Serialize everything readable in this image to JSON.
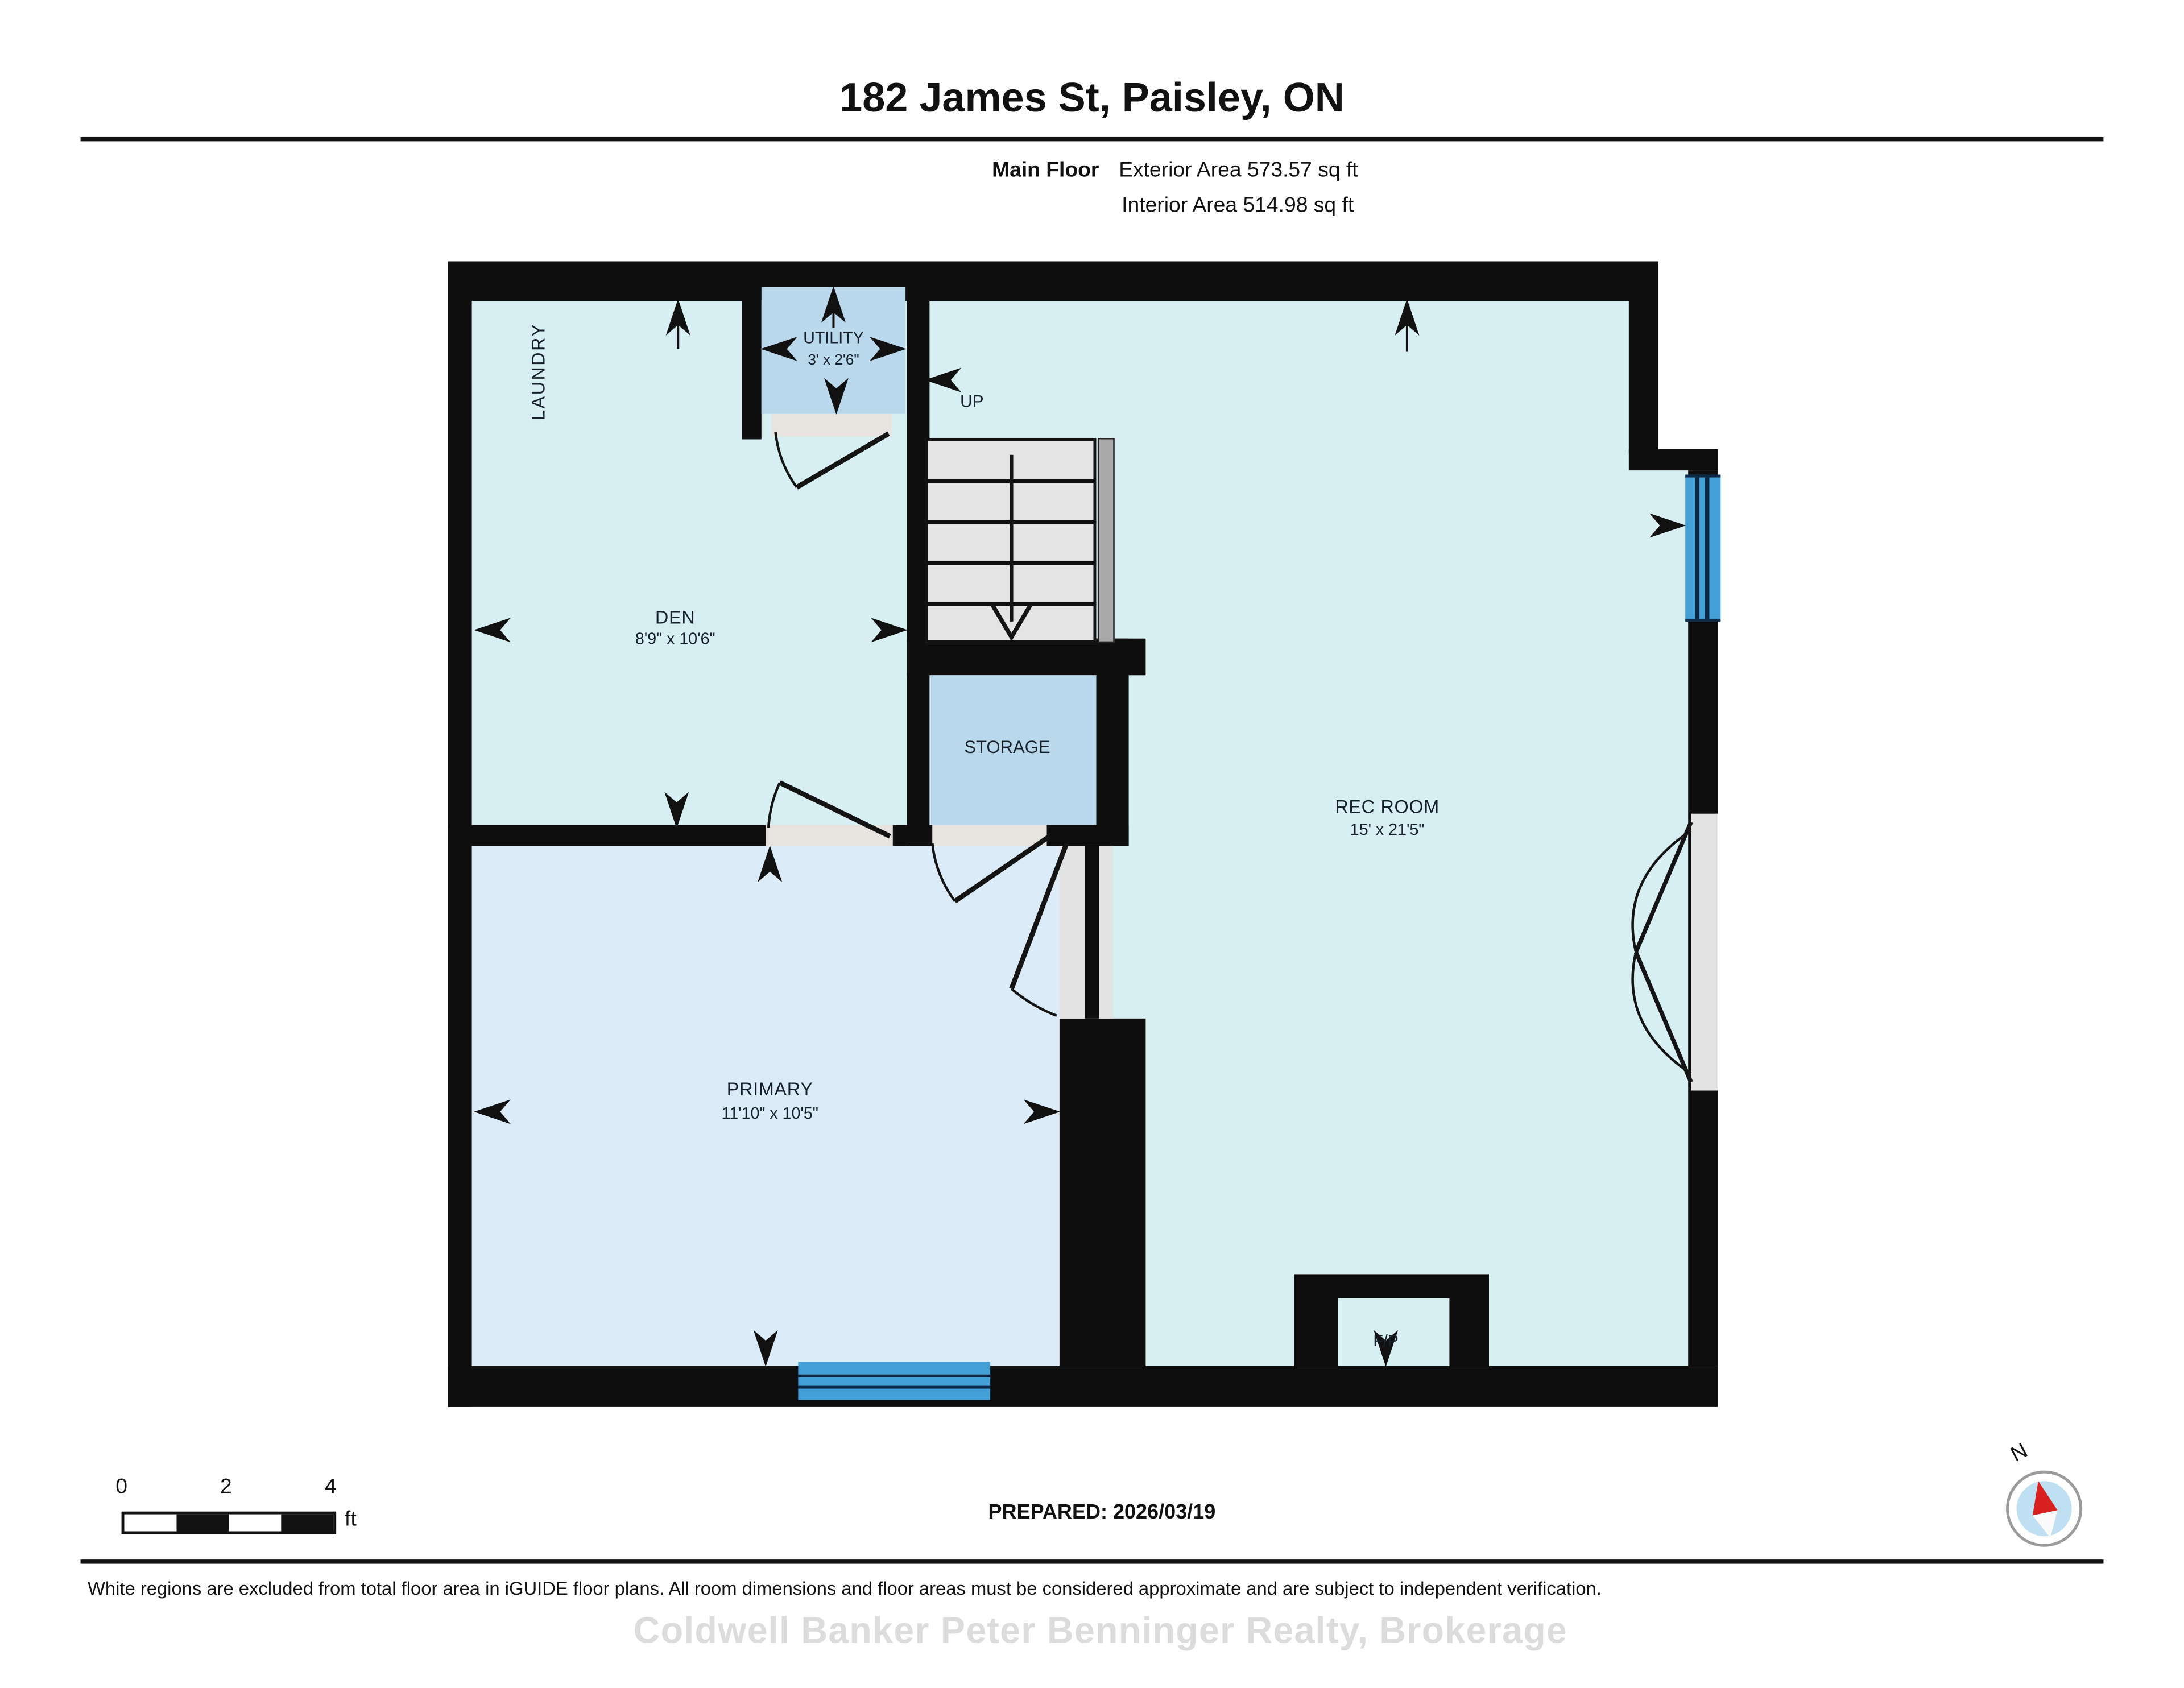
{
  "header": {
    "title": "182 James St, Paisley, ON",
    "floor_label": "Main Floor",
    "exterior_area": "Exterior Area 573.57 sq ft",
    "interior_area": "Interior Area 514.98 sq ft"
  },
  "plan": {
    "rooms": {
      "laundry": {
        "label": "LAUNDRY"
      },
      "utility": {
        "label": "UTILITY",
        "dims": "3' x 2'6\""
      },
      "den": {
        "label": "DEN",
        "dims": "8'9\" x 10'6\""
      },
      "storage": {
        "label": "STORAGE"
      },
      "rec_room": {
        "label": "REC ROOM",
        "dims": "15' x 21'5\""
      },
      "primary": {
        "label": "PRIMARY",
        "dims": "11'10\" x 10'5\""
      },
      "fireplace": {
        "label": "F/P"
      }
    },
    "stairs": {
      "label": "UP"
    }
  },
  "scale_bar": {
    "tick_labels": [
      "0",
      "2",
      "4"
    ],
    "unit": "ft"
  },
  "prepared": {
    "text": "PREPARED: 2026/03/19"
  },
  "compass": {
    "north_label": "N"
  },
  "footer": {
    "disclaimer": "White regions are excluded from total floor area in iGUIDE floor plans. All room dimensions and floor areas must be considered approximate and are subject to independent verification.",
    "watermark": "Coldwell Banker Peter Benninger Realty, Brokerage"
  },
  "colors": {
    "wall": "#0e0e0e",
    "room_fill": "#d7eff3",
    "primary_fill": "#dcebf8",
    "closet_fill": "#b9d8ec",
    "window": "#44a0d6",
    "window_stripe": "#0b2947",
    "stair_tread": "#e4e4e4",
    "handrail": "#a9a9a9",
    "threshold": "#e7e4e0",
    "compass_disc": "#bfe0f2",
    "compass_needle": "#d92121",
    "watermark_text": "#dcdcdc"
  }
}
